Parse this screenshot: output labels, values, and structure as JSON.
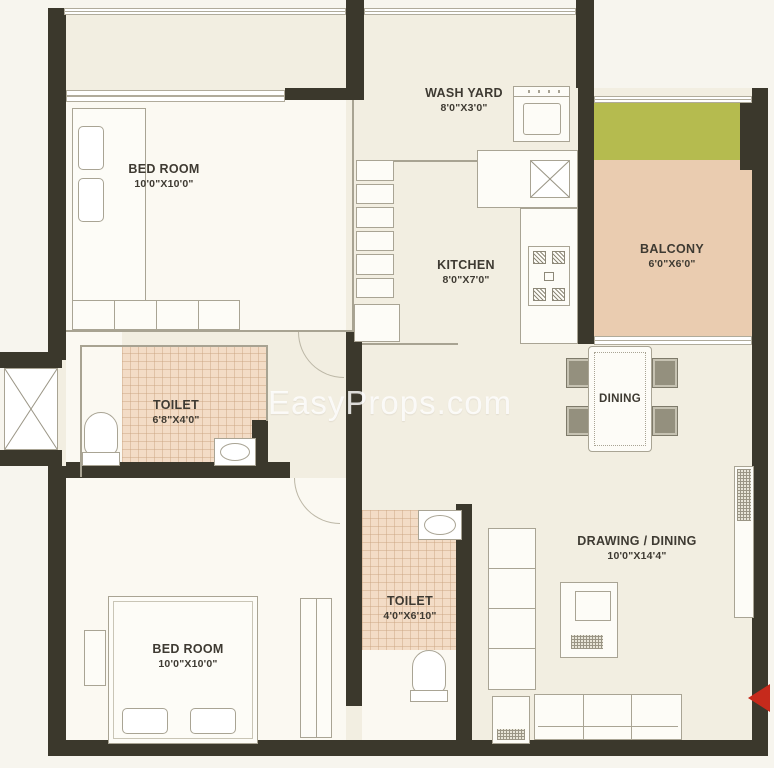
{
  "watermark": "EasyProps.com",
  "rooms": {
    "bedroom1": {
      "name": "BED ROOM",
      "dims": "10'0\"X10'0\""
    },
    "washyard": {
      "name": "WASH YARD",
      "dims": "8'0\"X3'0\""
    },
    "kitchen": {
      "name": "KITCHEN",
      "dims": "8'0\"X7'0\""
    },
    "balcony": {
      "name": "BALCONY",
      "dims": "6'0\"X6'0\""
    },
    "toilet1": {
      "name": "TOILET",
      "dims": "6'8\"X4'0\""
    },
    "dining": {
      "name": "DINING"
    },
    "drawing": {
      "name": "DRAWING / DINING",
      "dims": "10'0\"X14'4\""
    },
    "toilet2": {
      "name": "TOILET",
      "dims": "4'0\"X6'10\""
    },
    "bedroom2": {
      "name": "BED ROOM",
      "dims": "10'0\"X10'0\""
    }
  },
  "colors": {
    "wall": "#3b382c",
    "floor_beige": "#f2eee1",
    "room_white": "#fbf9f2",
    "balcony_tan": "#eaccb0",
    "toilet_tile": "#f3dcc6",
    "planter_green": "#b5bb4f",
    "entry_arrow_red": "#c62a1c",
    "label_text": "#3e3a32"
  }
}
